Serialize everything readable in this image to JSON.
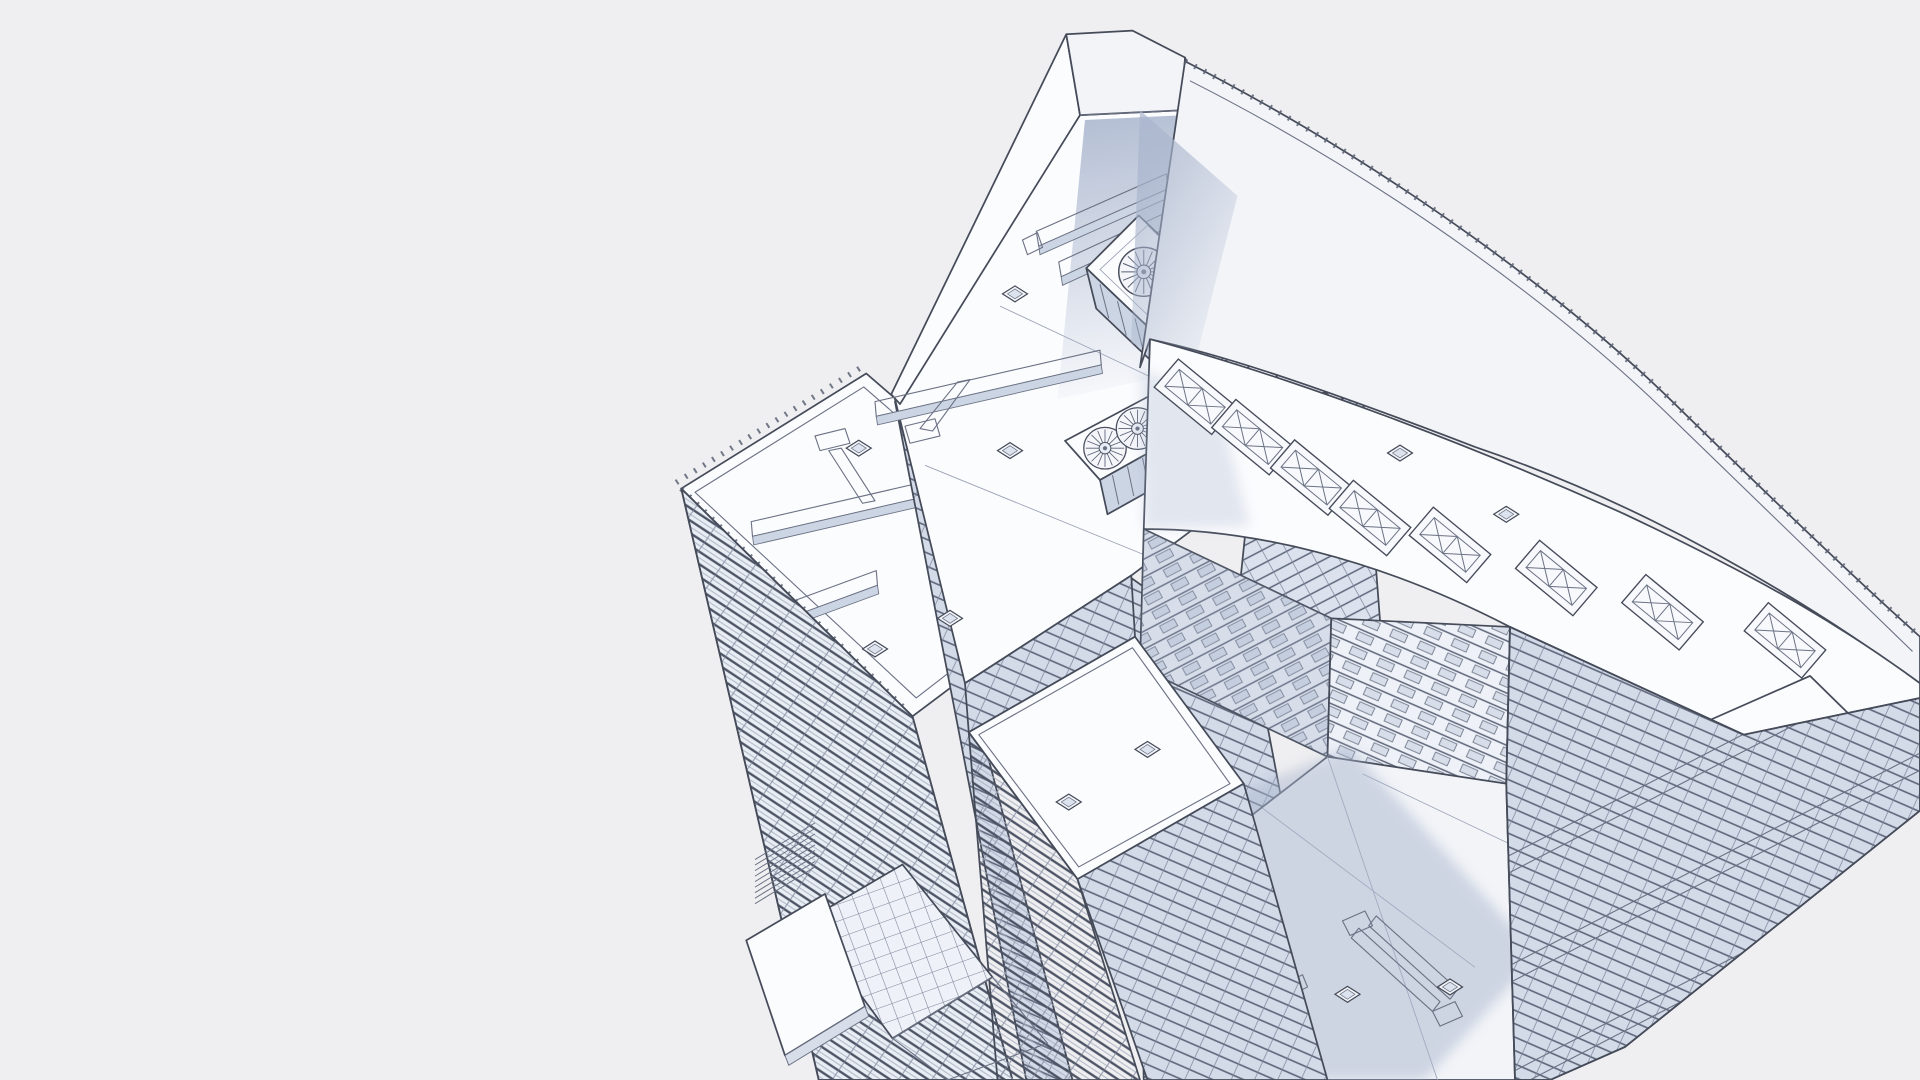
{
  "scene": {
    "description": "Monochrome 3D wireframe architectural rendering of a modern mixed-use high-rise complex seen from above in aerial axonometric view",
    "render_style": "white clay hidden-line wireframe render on plain light background",
    "background_label": "empty light-gray backdrop, no ground plane"
  },
  "colors": {
    "background": "#efeff1",
    "line_strong": "#454b59",
    "line_mid": "#6b7284",
    "line_faint": "#9aa2b4",
    "face_white": "#fbfcfe",
    "face_offwhite": "#f2f4f8",
    "face_light": "#e9edf4",
    "glass_light": "#dde4ef",
    "glass_mid": "#ccd5e4",
    "shade_soft": "#c7d0e2",
    "shadow_cast": "#a9b5cd"
  },
  "building": {
    "spire": {
      "label": "triangular sail spire with folded angular cap",
      "shading": "soft blue cast shadow falling from the sail onto the main roof"
    },
    "main_roof_equipment": {
      "cooling_unit_large_fan_count": 3,
      "cooling_unit_small_fan_count": 2,
      "fan_style": "round axial fans with radial blade spokes",
      "duct_run_count": 7,
      "roof_hatch_count": 16
    },
    "right_wing": {
      "label": "curved-edge wing with stepped parapet sweeping to the image edge",
      "skylight_count": 8,
      "skylight_style": "rectangular curbs with X cross-bracing",
      "penthouse": "small raised box near the south-east roof edge"
    },
    "left_slab": {
      "label": "residential slab tower",
      "facade_style": "dense stacked balcony floor bands with mullion ticks",
      "roof_features": [
        "perimeter railing posts",
        "T-shaped duct runs",
        "access hatches"
      ]
    },
    "central_tower": {
      "label": "glass curtain-wall tower below the sail roof",
      "facade_style": "gridded glazing panels with floor lines"
    },
    "courtyard_plaza": {
      "label": "sunken plaza between wings",
      "features": [
        "large diagonal cast shadow",
        "white service duct assemblies",
        "small square floor hatches"
      ]
    },
    "entrance_canopy": {
      "label": "street-level entrance canopy at lower left",
      "features": [
        "flat white slab",
        "gridded glass canopy",
        "stair hatching"
      ]
    },
    "south_east_block": {
      "label": "stepped terrace block with alternating glass floors and white parapet bands, cut by image edge"
    }
  }
}
